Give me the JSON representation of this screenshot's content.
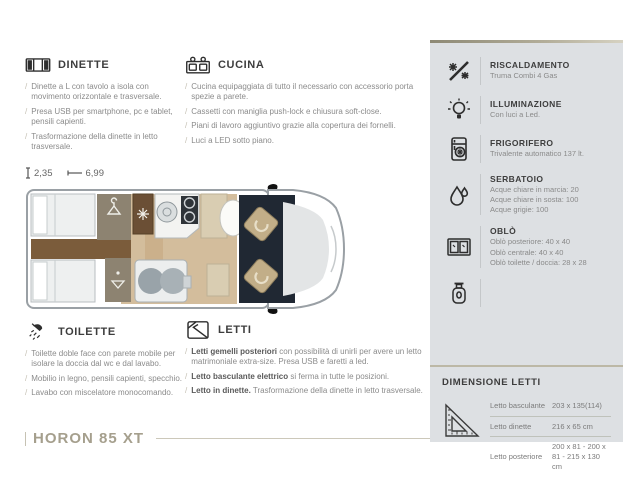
{
  "page": {
    "model": "HORON 85 XT",
    "colors": {
      "sidebar_bg": "#dde0e3",
      "accent_tan": "#a59f8d",
      "heading": "#3d3d3d",
      "body_text": "#8b8b8b"
    }
  },
  "floorplan": {
    "height_label": "2,35",
    "length_label": "6,99",
    "height_icon": "height-ruler-icon",
    "length_icon": "length-arrow-icon"
  },
  "sections": {
    "dinette": {
      "title": "DINETTE",
      "icon": "dinette-icon",
      "items": [
        "Dinette a L con tavolo a isola con movimento orizzontale e trasversale.",
        "Presa USB per smartphone, pc e tablet, pensili capienti.",
        "Trasformazione della dinette in letto trasversale."
      ]
    },
    "cucina": {
      "title": "CUCINA",
      "icon": "kitchen-icon",
      "items": [
        "Cucina equipaggiata di tutto il necessario con accessorio porta spezie a parete.",
        "Cassetti con maniglia push-lock e chiusura soft-close.",
        "Piani di lavoro aggiuntivo grazie alla copertura dei fornelli.",
        "Luci a LED sotto piano."
      ]
    },
    "toilette": {
      "title": "TOILETTE",
      "icon": "shower-icon",
      "items": [
        "Toilette doble face con parete mobile per isolare la doccia dal wc e dal lavabo.",
        "Mobilio in legno, pensili capienti, specchio.",
        "Lavabo con miscelatore monocomando."
      ]
    },
    "letti": {
      "title": "LETTI",
      "icon": "bed-icon",
      "items": [
        {
          "lead": "Letti gemelli posteriori",
          "rest": " con possibilità di unirli per avere un letto matrimoniale extra-size. Presa USB e faretti a led."
        },
        {
          "lead": "Letto basculante elettrico",
          "rest": " si ferma in tutte le posizioni."
        },
        {
          "lead": "Letto in dinette.",
          "rest": " Trasformazione della dinette in letto trasversale."
        }
      ]
    }
  },
  "sidebar": {
    "specs": [
      {
        "icon": "heating-icon",
        "title": "RISCALDAMENTO",
        "lines": [
          "Truma Combi 4 Gas"
        ]
      },
      {
        "icon": "lightbulb-icon",
        "title": "ILLUMINAZIONE",
        "lines": [
          "Con luci a Led."
        ]
      },
      {
        "icon": "fridge-icon",
        "title": "FRIGORIFERO",
        "lines": [
          "Trivalente automatico 137 lt."
        ]
      },
      {
        "icon": "water-drop-icon",
        "title": "SERBATOIO",
        "lines": [
          "Acque chiare in marcia: 20",
          "Acque chiare in sosta: 100",
          "Acque grigie: 100"
        ]
      },
      {
        "icon": "skylight-icon",
        "title": "OBLÒ",
        "lines": [
          "Oblò posteriore: 40 x 40",
          "Oblò centrale: 40 x 40",
          "Oblò toilette / doccia: 28 x 28"
        ]
      },
      {
        "icon": "gas-bottle-icon",
        "title": "",
        "lines": []
      }
    ],
    "bed_dimensions": {
      "title": "DIMENSIONE LETTI",
      "icon": "set-square-icon",
      "rows": [
        {
          "label": "Letto basculante",
          "value": "203 x 135(114)"
        },
        {
          "label": "Letto dinette",
          "value": "216 x 65 cm"
        },
        {
          "label": "Letto posteriore",
          "value": "200 x 81 - 200 x 81 - 215 x 130 cm"
        }
      ]
    }
  }
}
